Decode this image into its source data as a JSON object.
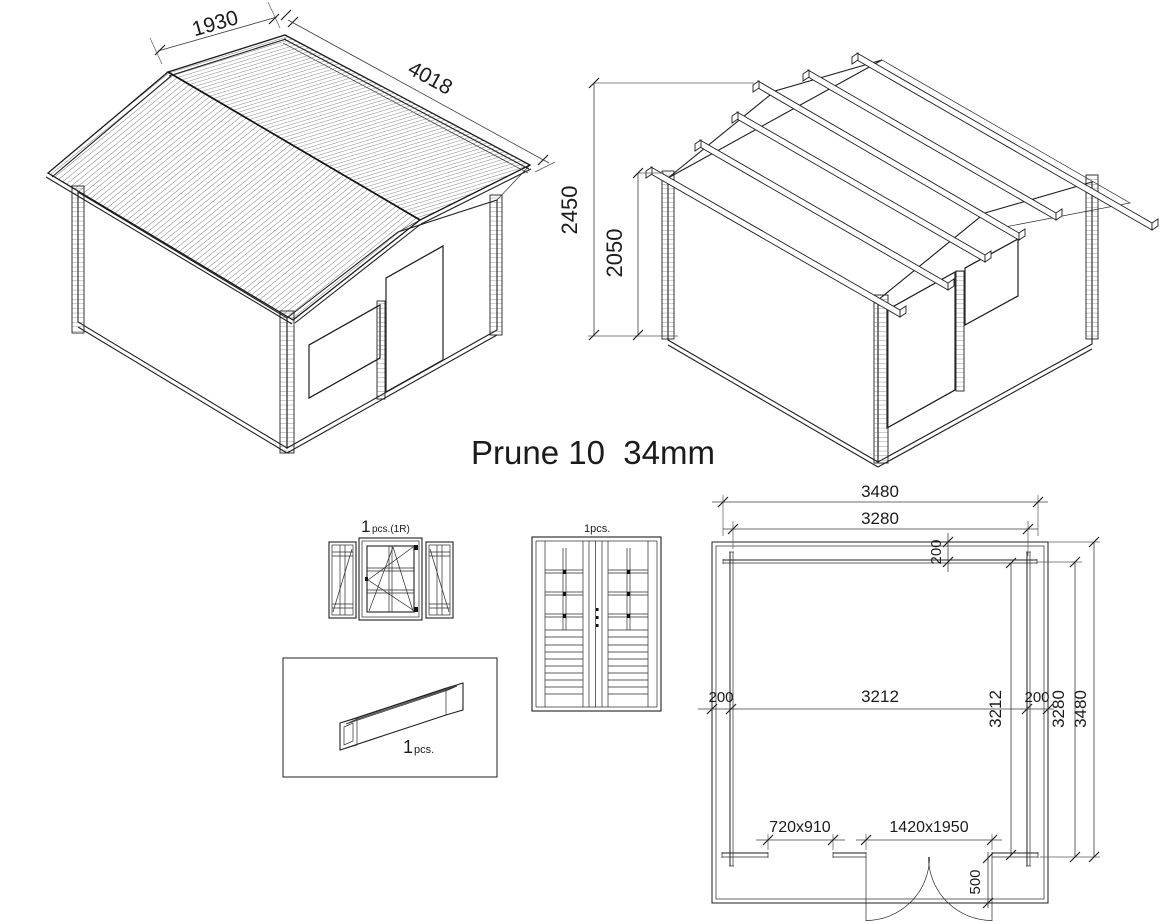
{
  "title": "Prune 10  34mm",
  "colors": {
    "ink": "#1f1f1f",
    "dim_line": "#3c3c3c",
    "background": "#ffffff"
  },
  "views": {
    "cabin_assembled": {
      "name": "assembled cabin isometric view",
      "dims": {
        "roof_slope_width": "1930",
        "roof_length": "4018"
      }
    },
    "cabin_frame": {
      "name": "roof frame isometric view",
      "dims": {
        "total_height": "2450",
        "wall_height": "2050"
      }
    },
    "window_detail": {
      "qty": "1",
      "qty_note": "pcs.(1R)"
    },
    "door_detail": {
      "qty_label": "1pcs."
    },
    "flower_box_detail": {
      "qty": "1",
      "qty_note": "pcs."
    },
    "floor_plan": {
      "dims": {
        "overall_width": "3480",
        "wall_outer_width": "3280",
        "rear_overhang": "200",
        "left_wall_offset": "200",
        "inner_width": "3212",
        "inner_depth": "3212",
        "right_wall_offset": "200",
        "wall_outer_depth": "3280",
        "overall_depth": "3480",
        "window_opening": "720x910",
        "door_opening": "1420x1950",
        "canopy_depth": "500"
      }
    }
  }
}
